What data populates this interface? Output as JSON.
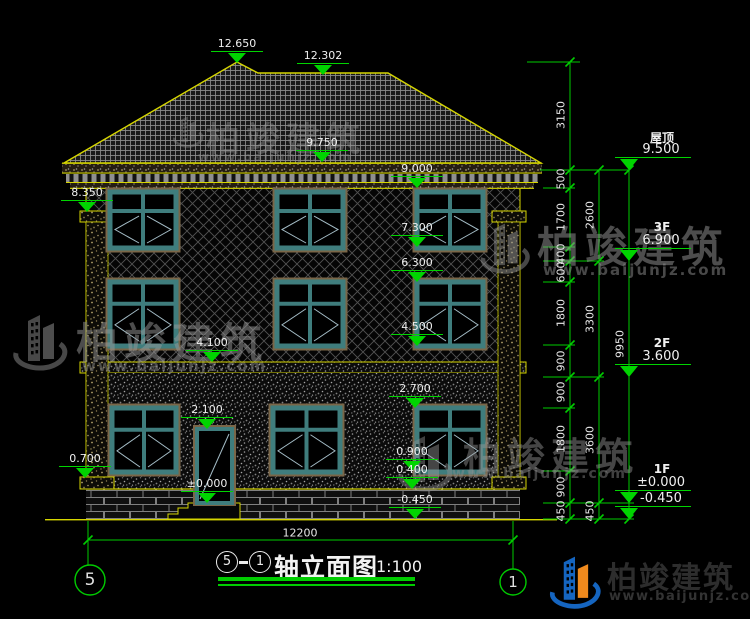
{
  "drawing_title": {
    "axis_start": "5",
    "separator": "—",
    "axis_end": "1",
    "name": "轴立面图",
    "scale": "1:100"
  },
  "axis_bubbles": {
    "left": "5",
    "right": "1"
  },
  "brand": {
    "name": "柏竣建筑",
    "url": "www.baijunjz.com"
  },
  "colors": {
    "dim_green": "#00cc00",
    "outline_yellow": "#d6d600",
    "text_white": "#e8e8e8",
    "window_teal": "#3f7d7d",
    "logo_blue": "#1565c0",
    "logo_orange": "#f08a1d"
  },
  "floor_levels": [
    {
      "name": "屋顶",
      "value": "9.500",
      "y": 170
    },
    {
      "name": "3F",
      "value": "6.900",
      "y": 261
    },
    {
      "name": "2F",
      "value": "3.600",
      "y": 377
    },
    {
      "name": "1F",
      "value": "±0.000",
      "y": 503
    },
    {
      "name": "",
      "value": "-0.450",
      "y": 519
    }
  ],
  "elevation_markers": [
    {
      "value": "12.650",
      "x": 237,
      "y": 63
    },
    {
      "value": "12.302",
      "x": 323,
      "y": 75
    },
    {
      "value": "9.750",
      "x": 322,
      "y": 162
    },
    {
      "value": "9.000",
      "x": 417,
      "y": 188
    },
    {
      "value": "8.350",
      "x": 87,
      "y": 212
    },
    {
      "value": "7.300",
      "x": 417,
      "y": 247
    },
    {
      "value": "6.300",
      "x": 417,
      "y": 282
    },
    {
      "value": "4.500",
      "x": 417,
      "y": 346
    },
    {
      "value": "4.100",
      "x": 212,
      "y": 362
    },
    {
      "value": "2.700",
      "x": 415,
      "y": 408
    },
    {
      "value": "2.100",
      "x": 207,
      "y": 429
    },
    {
      "value": "0.900",
      "x": 412,
      "y": 471
    },
    {
      "value": "0.400",
      "x": 412,
      "y": 489
    },
    {
      "value": "±0.000",
      "x": 207,
      "y": 503
    },
    {
      "value": "-0.450",
      "x": 415,
      "y": 519
    },
    {
      "value": "0.700",
      "x": 85,
      "y": 478
    }
  ],
  "dimensions": [
    {
      "text": "3150",
      "x": 561,
      "y": 115,
      "rot": true
    },
    {
      "text": "500",
      "x": 561,
      "y": 179,
      "rot": true
    },
    {
      "text": "1700",
      "x": 561,
      "y": 217,
      "rot": true
    },
    {
      "text": "400",
      "x": 561,
      "y": 254,
      "rot": true
    },
    {
      "text": "600",
      "x": 561,
      "y": 272,
      "rot": true
    },
    {
      "text": "1800",
      "x": 561,
      "y": 313,
      "rot": true
    },
    {
      "text": "900",
      "x": 561,
      "y": 361,
      "rot": true
    },
    {
      "text": "900",
      "x": 561,
      "y": 392,
      "rot": true
    },
    {
      "text": "1800",
      "x": 561,
      "y": 439,
      "rot": true
    },
    {
      "text": "900",
      "x": 561,
      "y": 487,
      "rot": true
    },
    {
      "text": "450",
      "x": 561,
      "y": 511,
      "rot": true
    },
    {
      "text": "2600",
      "x": 590,
      "y": 215,
      "rot": true
    },
    {
      "text": "3300",
      "x": 590,
      "y": 319,
      "rot": true
    },
    {
      "text": "3600",
      "x": 590,
      "y": 440,
      "rot": true
    },
    {
      "text": "450",
      "x": 590,
      "y": 511,
      "rot": true
    },
    {
      "text": "9950",
      "x": 620,
      "y": 344,
      "rot": true
    },
    {
      "text": "12200",
      "x": 300,
      "y": 533,
      "rot": false
    }
  ],
  "watermarks": [
    {
      "text": "柏竣建筑",
      "url": "www.baijunjz.com",
      "glyph": [
        170,
        108,
        36,
        46
      ],
      "text_pos": [
        206,
        112,
        34
      ],
      "url_pos": [
        198,
        150,
        12
      ],
      "opacity": 0.4
    },
    {
      "text": "柏竣建筑",
      "url": "www.baijunjz.com",
      "glyph": [
        8,
        300,
        64,
        82
      ],
      "text_pos": [
        76,
        310,
        42
      ],
      "url_pos": [
        82,
        357,
        15
      ],
      "opacity": 0.5
    },
    {
      "text": "柏竣建筑",
      "url": "www.baijunjz.com",
      "glyph": [
        476,
        208,
        58,
        78
      ],
      "text_pos": [
        537,
        214,
        42
      ],
      "url_pos": [
        543,
        261,
        15
      ],
      "opacity": 0.5
    },
    {
      "text": "柏竣建筑",
      "url": "www.baijunjz.com",
      "glyph": [
        393,
        418,
        64,
        88
      ],
      "text_pos": [
        463,
        426,
        38
      ],
      "url_pos": [
        452,
        466,
        14
      ],
      "opacity": 0.45
    }
  ]
}
